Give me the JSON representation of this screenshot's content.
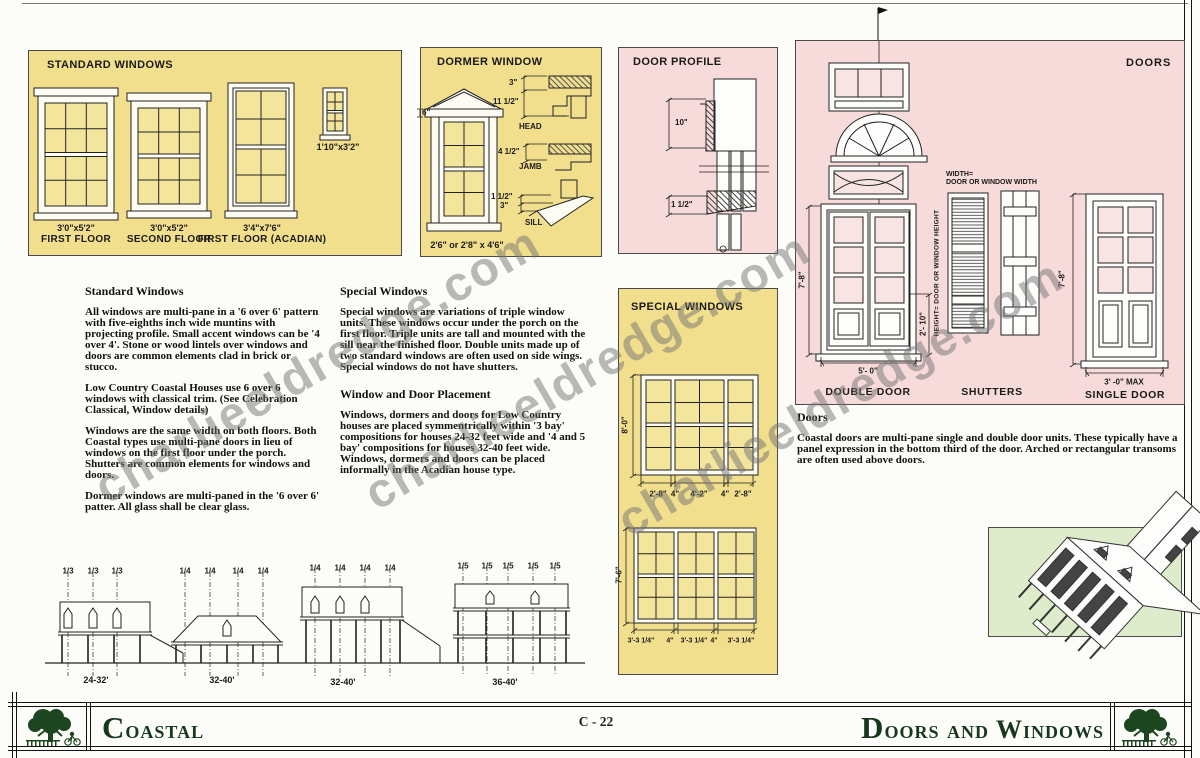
{
  "watermark": {
    "text": "charlieeldredge.com"
  },
  "standard_windows": {
    "title": "STANDARD WINDOWS",
    "items": [
      {
        "size": "3'0\"x5'2\"",
        "label": "FIRST  FLOOR"
      },
      {
        "size": "3'0\"x5'2\"",
        "label": "SECOND FLOOR"
      },
      {
        "size": "3'4\"x7'6\"",
        "label": "FIRST  FLOOR (ACADIAN)"
      },
      {
        "size": "1'10\"x3'2\"",
        "label": ""
      }
    ]
  },
  "dormer": {
    "title": "DORMER WINDOW",
    "size_caption": "2'6\" or 2'8\" x 4'6\"",
    "overhang_dim": "6\"",
    "head": {
      "dim1": "3\"",
      "dim2": "11 1/2\"",
      "label": "HEAD"
    },
    "jamb": {
      "dim1": "4 1/2\"",
      "label": "JAMB"
    },
    "sill": {
      "dim1": "1 1/2\"",
      "dim2": "3\"",
      "label": "SILL"
    }
  },
  "door_profile": {
    "title": "DOOR PROFILE",
    "dim_top": "10\"",
    "dim_bottom": "1 1/2\""
  },
  "doors_panel": {
    "title": "DOORS",
    "width_note_line1": "WIDTH=",
    "width_note_line2": "DOOR OR WINDOW WIDTH",
    "height_note": "HEIGHT= DOOR OR WINDOW HEIGHT",
    "double_door": {
      "height_dim": "7'-8\"",
      "panel_dim": "2'- 10\"",
      "width_dim": "5'- 0\"",
      "label": "DOUBLE DOOR"
    },
    "shutters": {
      "label": "SHUTTERS"
    },
    "single_door": {
      "height_dim": "7'-8\"",
      "width_dim": "3' -0\" MAX",
      "label": "SINGLE DOOR"
    }
  },
  "special_windows": {
    "title": "SPECIAL WINDOWS",
    "triple_tall": {
      "height_dim": "8'-0\"",
      "bottom_dims": [
        "2'-8\"",
        "4\"",
        "4'-2\"",
        "4\"",
        "2'-8\""
      ]
    },
    "triple_standard": {
      "height_dim": "7'-6\"",
      "bottom_dims": [
        "3'-3 1/4\"",
        "4\"",
        "3'-3 1/4\"",
        "4\"",
        "3'-3 1/4\""
      ]
    }
  },
  "sections": {
    "standard_windows": {
      "heading": "Standard Windows",
      "p1": "All windows are multi-pane in a '6 over 6' pattern with five-eighths inch wide muntins with projecting profile. Small accent windows can be '4 over 4'. Stone or wood lintels over windows and doors are common elements clad in brick or stucco.",
      "p2": "Low Country Coastal Houses use 6 over 6 windows with classical trim. (See Celebration Classical, Window details)",
      "p3": "Windows are the same width on both floors. Both Coastal types use multi-pane doors in lieu of windows on the first floor under the porch. Shutters are common elements for windows and doors.",
      "p4": "Dormer windows are multi-paned in the '6 over 6' patter. All glass shall be clear glass."
    },
    "special_windows": {
      "heading": "Special Windows",
      "p1": "Special windows are variations of triple window units. These windows occur under the porch on the first floor. Triple units are tall and mounted with the sill near the finished floor. Double units made up of two standard windows are often used on side wings. Special windows do not have shutters."
    },
    "placement": {
      "heading": "Window and Door Placement",
      "p1": "Windows, dormers and doors for Low Country houses are placed symmentrically within '3 bay' compositions for houses 24-32 feet wide and '4 and 5 bay' compositions for houses 32-40 feet wide. Windows, dormers and doors can be placed informally in the Acadian house type."
    },
    "doors": {
      "heading": "Doors",
      "p1": "Coastal doors are multi-pane single and double door units. These typically have a panel expression in the bottom third of the door. Arched or rectangular transoms are often used above doors."
    }
  },
  "elevations": {
    "groups": [
      {
        "fractions": [
          "1/3",
          "1/3",
          "1/3"
        ],
        "width": "24-32'"
      },
      {
        "fractions": [
          "1/4",
          "1/4",
          "1/4",
          "1/4"
        ],
        "width": "32-40'"
      },
      {
        "fractions": [
          "1/4",
          "1/4",
          "1/4",
          "1/4"
        ],
        "width": "32-40'"
      },
      {
        "fractions": [
          "1/5",
          "1/5",
          "1/5",
          "1/5",
          "1/5"
        ],
        "width": "36-40'"
      }
    ]
  },
  "footer": {
    "series": "Coastal",
    "sheet": "C - 22",
    "title": "Doors and Windows"
  },
  "colors": {
    "panel_yellow": "#f2df8d",
    "panel_pink": "#f6dbda",
    "panel_green": "#dfeccb",
    "footer_green": "#17381f"
  }
}
